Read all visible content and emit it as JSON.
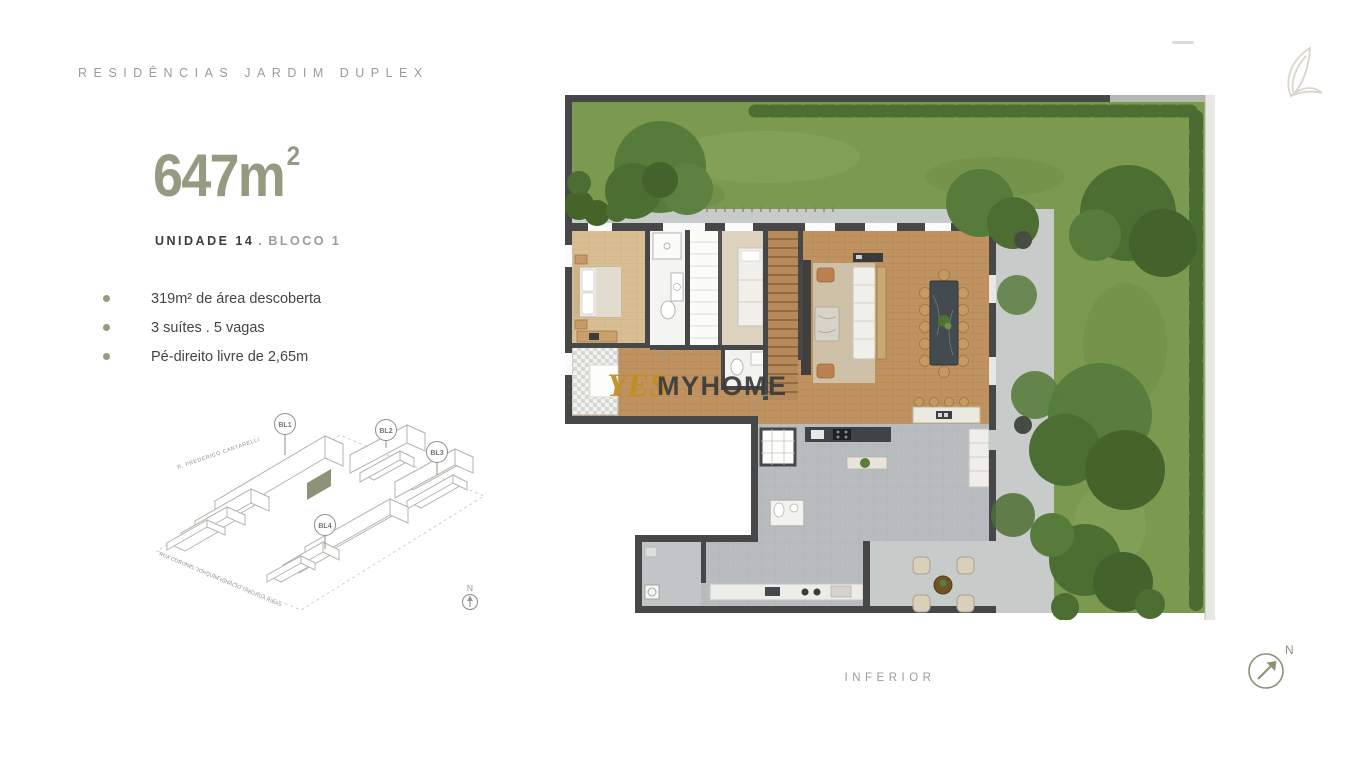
{
  "header": {
    "title": "RESIDÊNCIAS JARDIM DUPLEX"
  },
  "unit": {
    "area_value": "647m",
    "area_exponent": "2",
    "unit_label": "UNIDADE 14",
    "separator": ".",
    "block_label": "BLOCO 1",
    "features": [
      "319m² de área descoberta",
      "3 suítes .  5 vagas",
      "Pé-direito livre de 2,65m"
    ]
  },
  "site_plan": {
    "blocks": [
      "BL1",
      "BL2",
      "BL3",
      "BL4"
    ],
    "streets": [
      "R. FREDERICO CANTARELLI",
      "RUA CORONEL JOAQUIM IGNÁCIO TABORDA RIBAS"
    ],
    "north_label": "N"
  },
  "floor_plan": {
    "watermark": {
      "yes": "YES",
      "myhome": "MYHOME"
    },
    "level_label": "INFERIOR",
    "north_label": "N"
  },
  "colors": {
    "accent": "#959b80",
    "heading_gray": "#9b9b97",
    "text_dark": "#3d3d3b"
  }
}
